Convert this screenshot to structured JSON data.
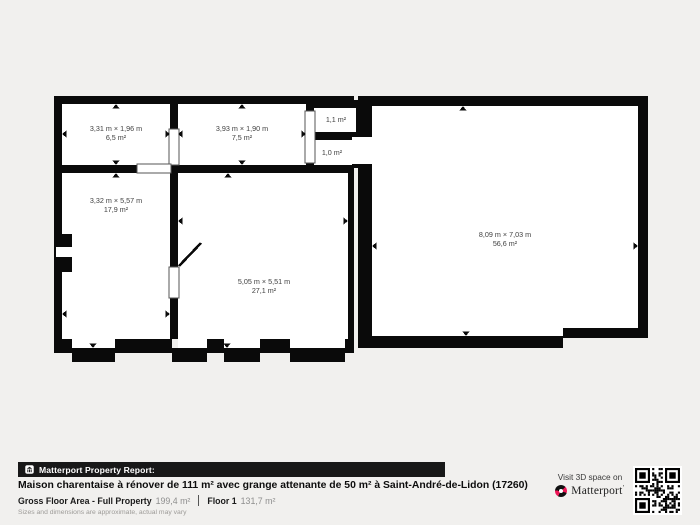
{
  "plan": {
    "wall_color": "#0a0a0a",
    "background_color": "#f1f0ee",
    "rooms": [
      {
        "name": "top-left-room",
        "label": "3,31 m × 1,96 m",
        "area": "6,5 m²"
      },
      {
        "name": "top-mid-room",
        "label": "3,93 m × 1,90 m",
        "area": "7,5 m²"
      },
      {
        "name": "closet-upper",
        "area": "1,1 m²"
      },
      {
        "name": "closet-lower",
        "area": "1,0 m²"
      },
      {
        "name": "left-room",
        "label": "3,32 m × 5,57 m",
        "area": "17,9 m²"
      },
      {
        "name": "main-room",
        "label": "5,05 m × 5,51 m",
        "area": "27,1 m²"
      },
      {
        "name": "barn",
        "label": "8,09 m × 7,03 m",
        "area": "56,6 m²"
      }
    ]
  },
  "footer": {
    "report_bar": "Matterport Property Report:",
    "title": "Maison charentaise à rénover de 111 m² avec grange attenante de 50 m² à Saint-André-de-Lidon (17260)",
    "gross_label": "Gross Floor Area - Full Property",
    "gross_value": "199,4 m²",
    "floor_label": "Floor 1",
    "floor_value": "131,7 m²",
    "disclaimer": "Sizes and dimensions are approximate, actual may vary",
    "visit_text": "Visit 3D space on",
    "brand": "Matterport",
    "brand_mark": "’",
    "accent_red": "#ee1757"
  }
}
